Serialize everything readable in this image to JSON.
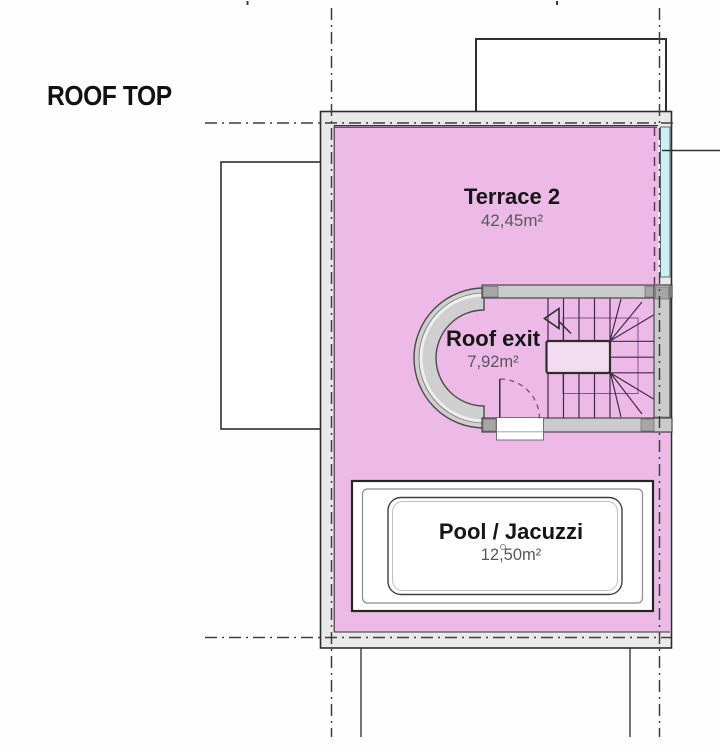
{
  "page": {
    "title": "ROOF TOP"
  },
  "rooms": {
    "terrace": {
      "name": "Terrace 2",
      "area": "42,45m²"
    },
    "roof_exit": {
      "name": "Roof exit",
      "area": "7,92m²"
    },
    "pool": {
      "name": "Pool / Jacuzzi",
      "area": "12,50m²"
    }
  },
  "colors": {
    "terrace_fill": "#edbae8",
    "glass_strip": "#c9f1f5",
    "wall_fill": "#cbcbcb",
    "wall_end_cap": "#a6a6a6",
    "boundary_dashdot_line": "#3f3f3f",
    "unit_edge_purple": "#6a3070",
    "stair_line": "#3f2b45",
    "landing_fill": "#f2dcef",
    "label_dark": "#161616",
    "label_gray": "#575757"
  }
}
